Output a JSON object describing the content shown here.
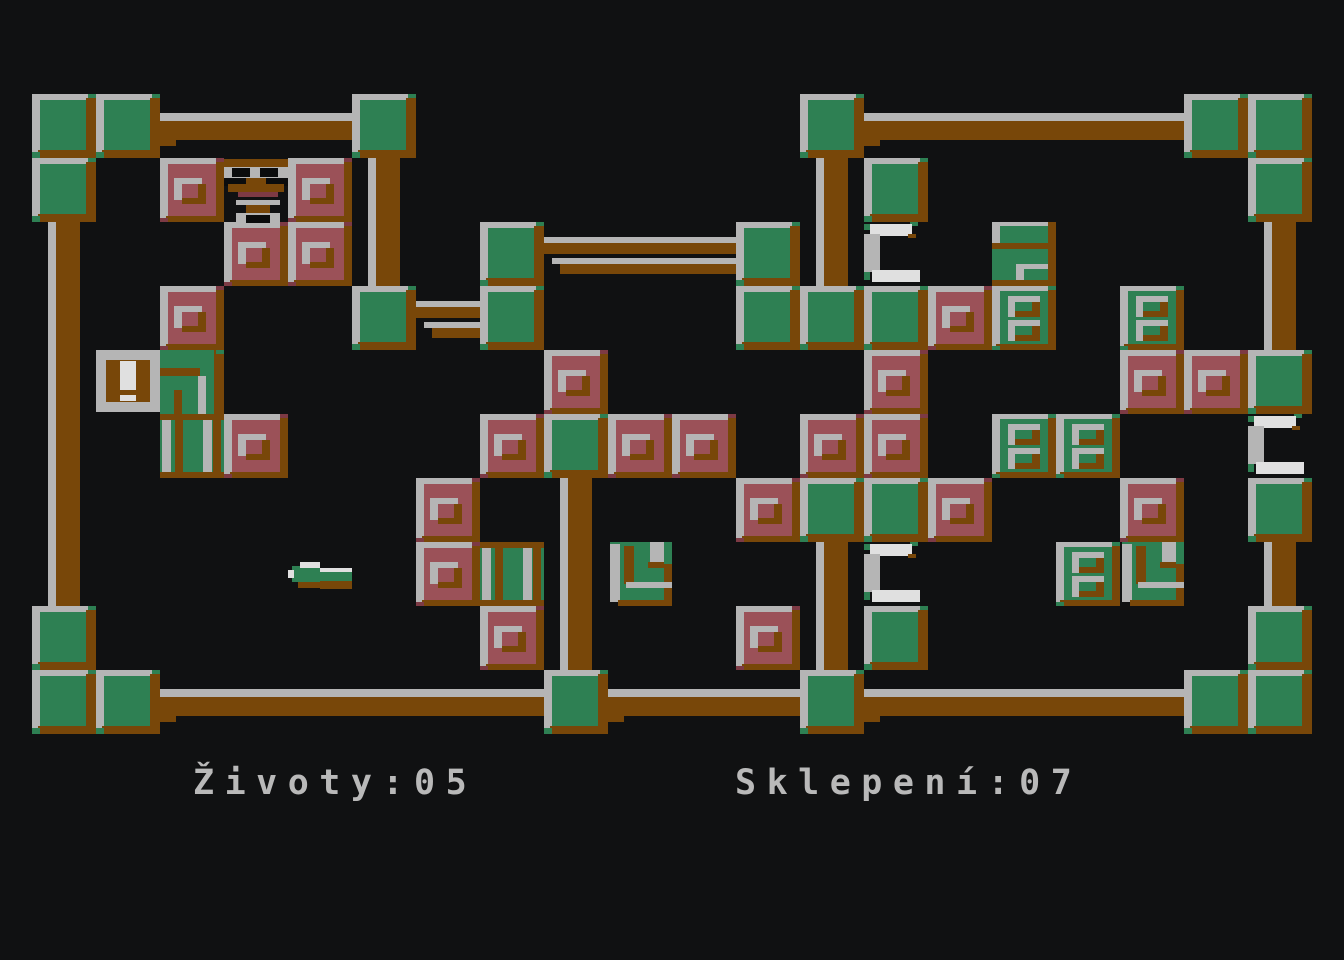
{
  "palette": {
    "background": "#101112",
    "black": "#0b0c0d",
    "green": "#2e8053",
    "brown": "#784709",
    "silver": "#b5b5b5",
    "pink": "#9b5158",
    "maroon": "#7d3a44",
    "white": "#e0e0e0",
    "text": "#b9b9b9"
  },
  "status": {
    "lives_label": "Životy",
    "lives_value": "05",
    "lives_text": "Životy:05",
    "dungeon_label": "Sklepení",
    "dungeon_value": "07",
    "dungeon_text": "Sklepení:07"
  },
  "grid": {
    "origin_x": 32,
    "origin_y": 94,
    "cell": 64,
    "cols": 20,
    "rows": 10
  },
  "tile_legend": "blocks:[type,col,row]  pole:[\"pole\",col,row,rows_tall]  beam:[\"beam\",col,row,cols_wide,variant]",
  "board": {
    "tiles": [
      [
        "beam",
        2,
        0,
        3,
        1
      ],
      [
        "beam",
        13,
        0,
        5,
        1
      ],
      [
        "beam",
        8,
        2,
        3,
        2
      ],
      [
        "beam",
        6,
        3,
        1,
        2
      ],
      [
        "beam",
        2,
        9,
        6,
        1
      ],
      [
        "beam",
        9,
        9,
        3,
        1
      ],
      [
        "beam",
        13,
        9,
        5,
        1
      ],
      [
        "pole",
        0,
        2,
        6
      ],
      [
        "pole",
        5,
        1,
        2
      ],
      [
        "pole",
        12,
        1,
        2
      ],
      [
        "pole",
        19,
        2,
        2
      ],
      [
        "pole",
        8,
        6,
        3
      ],
      [
        "pole",
        12,
        7,
        2
      ],
      [
        "pole",
        19,
        7,
        1
      ],
      [
        "green",
        0,
        0
      ],
      [
        "green",
        1,
        0
      ],
      [
        "green",
        5,
        0
      ],
      [
        "green",
        12,
        0
      ],
      [
        "green",
        18,
        0
      ],
      [
        "green",
        19,
        0
      ],
      [
        "green",
        0,
        1
      ],
      [
        "green",
        13,
        1
      ],
      [
        "green",
        19,
        1
      ],
      [
        "green",
        7,
        2
      ],
      [
        "green",
        11,
        2
      ],
      [
        "green",
        5,
        3
      ],
      [
        "green",
        7,
        3
      ],
      [
        "green",
        11,
        3
      ],
      [
        "green",
        12,
        3
      ],
      [
        "green",
        13,
        3
      ],
      [
        "green",
        19,
        4
      ],
      [
        "green",
        8,
        5
      ],
      [
        "green",
        12,
        6
      ],
      [
        "green",
        13,
        6
      ],
      [
        "green",
        19,
        6
      ],
      [
        "green",
        0,
        8
      ],
      [
        "green",
        13,
        8
      ],
      [
        "green",
        19,
        8
      ],
      [
        "green",
        0,
        9
      ],
      [
        "green",
        1,
        9
      ],
      [
        "green",
        8,
        9
      ],
      [
        "green",
        12,
        9
      ],
      [
        "green",
        18,
        9
      ],
      [
        "green",
        19,
        9
      ],
      [
        "pink",
        2,
        1
      ],
      [
        "pink",
        4,
        1
      ],
      [
        "pink",
        3,
        2
      ],
      [
        "pink",
        4,
        2
      ],
      [
        "pink",
        2,
        3
      ],
      [
        "pink",
        14,
        3
      ],
      [
        "pink",
        8,
        4
      ],
      [
        "pink",
        13,
        4
      ],
      [
        "pink",
        17,
        4
      ],
      [
        "pink",
        18,
        4
      ],
      [
        "pink",
        3,
        5
      ],
      [
        "pink",
        7,
        5
      ],
      [
        "pink",
        9,
        5
      ],
      [
        "pink",
        10,
        5
      ],
      [
        "pink",
        12,
        5
      ],
      [
        "pink",
        13,
        5
      ],
      [
        "pink",
        6,
        6
      ],
      [
        "pink",
        11,
        6
      ],
      [
        "pink",
        14,
        6
      ],
      [
        "pink",
        17,
        6
      ],
      [
        "pink",
        6,
        7
      ],
      [
        "pink",
        7,
        8
      ],
      [
        "pink",
        11,
        8
      ],
      [
        "win2",
        15,
        3
      ],
      [
        "win2",
        17,
        3
      ],
      [
        "win2",
        15,
        5
      ],
      [
        "win2",
        16,
        5
      ],
      [
        "win2",
        16,
        7
      ],
      [
        "stack",
        15,
        2
      ],
      [
        "stripes",
        2,
        5
      ],
      [
        "stripes",
        7,
        7
      ],
      [
        "door",
        2,
        4
      ],
      [
        "bang",
        1,
        4
      ],
      [
        "key",
        9,
        7
      ],
      [
        "key",
        17,
        7
      ],
      [
        "spider",
        3,
        1
      ],
      [
        "arrow",
        4,
        7
      ],
      [
        "horseshoe",
        13,
        2
      ],
      [
        "horseshoe",
        13,
        7
      ],
      [
        "horseshoe",
        19,
        5
      ]
    ]
  }
}
